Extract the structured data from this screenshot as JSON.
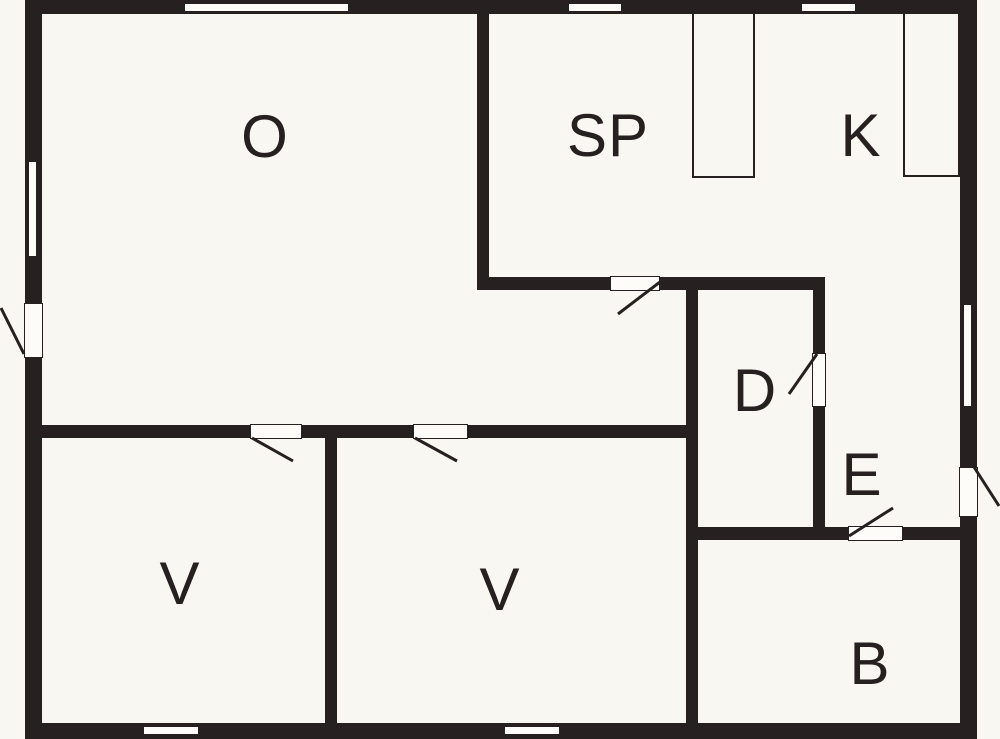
{
  "plan": {
    "type": "floor-plan"
  },
  "colors": {
    "background": "#f9f7f2",
    "wall": "#262021",
    "opening_fill": "#fdfcf8"
  },
  "rooms": {
    "o": {
      "label": "O"
    },
    "sp": {
      "label": "SP"
    },
    "k": {
      "label": "K"
    },
    "d": {
      "label": "D"
    },
    "e": {
      "label": "E"
    },
    "v1": {
      "label": "V"
    },
    "v2": {
      "label": "V"
    },
    "b": {
      "label": "B"
    }
  }
}
